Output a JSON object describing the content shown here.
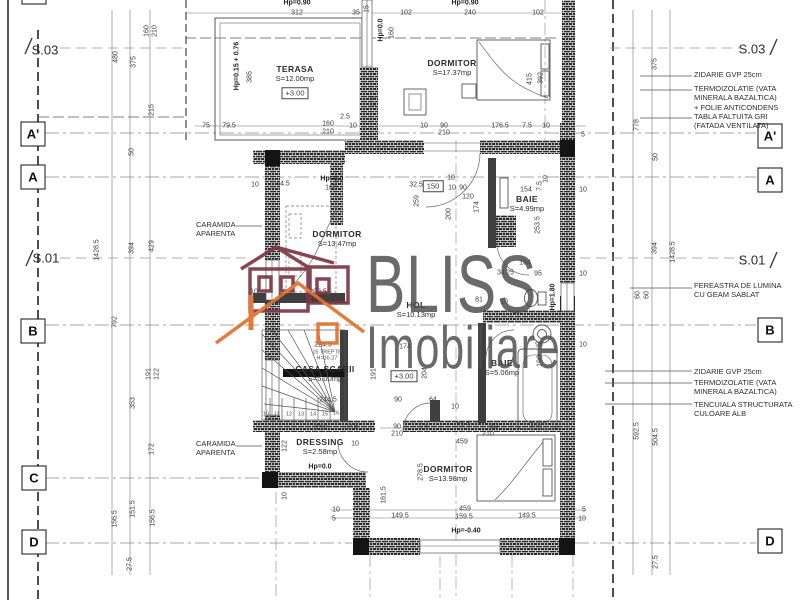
{
  "watermark": {
    "line1": "BLISS",
    "line2": "Imobiliare"
  },
  "grid_bubbles": [
    {
      "label": "",
      "x": 34,
      "y": -8
    },
    {
      "label": "A'",
      "x": 33,
      "y": 134
    },
    {
      "label": "A",
      "x": 33,
      "y": 177
    },
    {
      "label": "B",
      "x": 33,
      "y": 331
    },
    {
      "label": "C",
      "x": 34,
      "y": 478
    },
    {
      "label": "D",
      "x": 34,
      "y": 542
    },
    {
      "label": "A'",
      "x": 770,
      "y": 136
    },
    {
      "label": "A",
      "x": 770,
      "y": 180
    },
    {
      "label": "B",
      "x": 770,
      "y": 330
    },
    {
      "label": "D",
      "x": 770,
      "y": 541
    }
  ],
  "sections": [
    {
      "label": "S.03",
      "x": 45,
      "y": 50
    },
    {
      "label": "S.03",
      "x": 752,
      "y": 49
    },
    {
      "label": "S.01",
      "x": 46,
      "y": 258
    },
    {
      "label": "S.01",
      "x": 752,
      "y": 260
    }
  ],
  "rooms": [
    {
      "name": "TERASA",
      "area": "S=12.00mp",
      "x": 295,
      "y": 74
    },
    {
      "name": "DORMITOR",
      "area": "S=17.37mp",
      "x": 452,
      "y": 68
    },
    {
      "name": "DORMITOR",
      "area": "S=13.47mp",
      "x": 337,
      "y": 239
    },
    {
      "name": "BAIE",
      "area": "S=4.99mp",
      "x": 527,
      "y": 204
    },
    {
      "name": "HOL",
      "area": "S=10.13mp",
      "x": 416,
      "y": 310
    },
    {
      "name": "CASA SCARII",
      "area": "S=5.00mp",
      "x": 325,
      "y": 374
    },
    {
      "name": "BAIE",
      "area": "S=5.06mp",
      "x": 502,
      "y": 368
    },
    {
      "name": "DRESSING",
      "area": "S=2.58mp",
      "x": 320,
      "y": 447
    },
    {
      "name": "DORMITOR",
      "area": "S=13.98mp",
      "x": 448,
      "y": 474
    }
  ],
  "annotations": {
    "left": [
      {
        "lines": [
          "CARAMIDA",
          "APARENTA"
        ],
        "x": 196,
        "y": 220
      },
      {
        "lines": [
          "CARAMIDA",
          "APARENTA"
        ],
        "x": 196,
        "y": 439
      }
    ],
    "right": [
      {
        "lines": [
          "ZIDARIE GVP 25cm"
        ],
        "x": 694,
        "y": 70
      },
      {
        "lines": [
          "TERMOIZOLATIE (VATA",
          "MINERALA BAZALTICA)",
          "+ FOLIE ANTICONDENS"
        ],
        "x": 694,
        "y": 84
      },
      {
        "lines": [
          "TABLA FALTUITA GRI",
          "(FATADA VENTILATA)"
        ],
        "x": 694,
        "y": 112
      },
      {
        "lines": [
          "FEREASTRA DE LUMINA",
          "CU GEAM SABLAT"
        ],
        "x": 694,
        "y": 281
      },
      {
        "lines": [
          "ZIDARIE GVP 25cm"
        ],
        "x": 694,
        "y": 367
      },
      {
        "lines": [
          "TERMOIZOLATIE (VATA",
          "MINERALA BAZALTICA)"
        ],
        "x": 694,
        "y": 378
      },
      {
        "lines": [
          "TENCUIALA STRUCTURATA",
          "CULOARE ALB"
        ],
        "x": 694,
        "y": 400
      }
    ]
  },
  "labels": [
    {
      "t": "Hp=0.90",
      "x": 297,
      "y": 3,
      "b": 1
    },
    {
      "t": "312",
      "x": 297,
      "y": 13
    },
    {
      "t": "35",
      "x": 356,
      "y": 13
    },
    {
      "t": "15",
      "x": 367,
      "y": 9,
      "r": 1
    },
    {
      "t": "102",
      "x": 406,
      "y": 13
    },
    {
      "t": "Hp=0.90",
      "x": 465,
      "y": 3,
      "b": 1
    },
    {
      "t": "240",
      "x": 470,
      "y": 13
    },
    {
      "t": "102",
      "x": 538,
      "y": 13
    },
    {
      "t": "Hp=0.0",
      "x": 381,
      "y": 30,
      "r": 1,
      "b": 1
    },
    {
      "t": "160",
      "x": 392,
      "y": 33,
      "r": 1
    },
    {
      "t": "Hp=0.15 + 0.76",
      "x": 237,
      "y": 66,
      "r": 1,
      "b": 1
    },
    {
      "t": "385",
      "x": 250,
      "y": 77,
      "r": 1
    },
    {
      "t": "175",
      "x": 374,
      "y": 102,
      "r": 1
    },
    {
      "t": "75",
      "x": 206,
      "y": 126
    },
    {
      "t": "79.5",
      "x": 229,
      "y": 126
    },
    {
      "t": "160",
      "x": 328,
      "y": 124
    },
    {
      "t": "210",
      "x": 328,
      "y": 132
    },
    {
      "t": "2.5",
      "x": 345,
      "y": 117
    },
    {
      "t": "10",
      "x": 353,
      "y": 126
    },
    {
      "t": "10",
      "x": 424,
      "y": 126
    },
    {
      "t": "90",
      "x": 444,
      "y": 126
    },
    {
      "t": "210",
      "x": 444,
      "y": 133
    },
    {
      "t": "176.5",
      "x": 500,
      "y": 126
    },
    {
      "t": "7.5",
      "x": 527,
      "y": 126
    },
    {
      "t": "10",
      "x": 546,
      "y": 126
    },
    {
      "t": "5",
      "x": 583,
      "y": 135
    },
    {
      "t": "415",
      "x": 530,
      "y": 79,
      "r": 1
    },
    {
      "t": "392",
      "x": 541,
      "y": 78,
      "r": 1
    },
    {
      "t": "480",
      "x": 116,
      "y": 57,
      "r": 1
    },
    {
      "t": "375",
      "x": 134,
      "y": 62,
      "r": 1
    },
    {
      "t": "160",
      "x": 147,
      "y": 31,
      "r": 1
    },
    {
      "t": "210",
      "x": 155,
      "y": 31,
      "r": 1
    },
    {
      "t": "215",
      "x": 152,
      "y": 110,
      "r": 1
    },
    {
      "t": "50",
      "x": 132,
      "y": 152,
      "r": 1
    },
    {
      "t": "1428.5",
      "x": 97,
      "y": 250,
      "r": 1
    },
    {
      "t": "394",
      "x": 132,
      "y": 248,
      "r": 1
    },
    {
      "t": "429",
      "x": 152,
      "y": 246,
      "r": 1
    },
    {
      "t": "792",
      "x": 115,
      "y": 322,
      "r": 1
    },
    {
      "t": "191",
      "x": 149,
      "y": 374,
      "r": 1
    },
    {
      "t": "122",
      "x": 157,
      "y": 374,
      "r": 1
    },
    {
      "t": "353",
      "x": 133,
      "y": 403,
      "r": 1
    },
    {
      "t": "172",
      "x": 152,
      "y": 449,
      "r": 1
    },
    {
      "t": "156.5",
      "x": 115,
      "y": 519,
      "r": 1
    },
    {
      "t": "151.5",
      "x": 133,
      "y": 509,
      "r": 1
    },
    {
      "t": "156.5",
      "x": 153,
      "y": 518,
      "r": 1
    },
    {
      "t": "27.5",
      "x": 130,
      "y": 564,
      "r": 1
    },
    {
      "t": "375",
      "x": 655,
      "y": 64,
      "r": 1
    },
    {
      "t": "778",
      "x": 637,
      "y": 125,
      "r": 1
    },
    {
      "t": "50",
      "x": 656,
      "y": 157,
      "r": 1
    },
    {
      "t": "394",
      "x": 655,
      "y": 248,
      "r": 1
    },
    {
      "t": "1428.5",
      "x": 673,
      "y": 252,
      "r": 1
    },
    {
      "t": "60",
      "x": 638,
      "y": 295,
      "r": 1
    },
    {
      "t": "60",
      "x": 647,
      "y": 295,
      "r": 1
    },
    {
      "t": "592.5",
      "x": 637,
      "y": 431,
      "r": 1
    },
    {
      "t": "504.5",
      "x": 656,
      "y": 437,
      "r": 1
    },
    {
      "t": "27.5",
      "x": 656,
      "y": 562,
      "r": 1
    },
    {
      "t": "10",
      "x": 255,
      "y": 185
    },
    {
      "t": "44.5",
      "x": 283,
      "y": 184
    },
    {
      "t": "Hp=0.0",
      "x": 332,
      "y": 179,
      "b": 1
    },
    {
      "t": "160",
      "x": 331,
      "y": 188
    },
    {
      "t": "32.5",
      "x": 416,
      "y": 185
    },
    {
      "t": "150",
      "x": 433,
      "y": 186,
      "box": 1
    },
    {
      "t": "10",
      "x": 451,
      "y": 178
    },
    {
      "t": "10",
      "x": 452,
      "y": 188
    },
    {
      "t": "90",
      "x": 463,
      "y": 188
    },
    {
      "t": "120",
      "x": 468,
      "y": 197
    },
    {
      "t": "174",
      "x": 477,
      "y": 207,
      "r": 1
    },
    {
      "t": "259",
      "x": 417,
      "y": 201,
      "r": 1
    },
    {
      "t": "200",
      "x": 449,
      "y": 214,
      "r": 1
    },
    {
      "t": "154",
      "x": 526,
      "y": 190
    },
    {
      "t": "7.5",
      "x": 540,
      "y": 186,
      "r": 1
    },
    {
      "t": "10",
      "x": 546,
      "y": 179,
      "r": 1
    },
    {
      "t": "10",
      "x": 583,
      "y": 190
    },
    {
      "t": "253.5",
      "x": 538,
      "y": 225,
      "r": 1
    },
    {
      "t": "209.5",
      "x": 318,
      "y": 292
    },
    {
      "t": "10",
      "x": 254,
      "y": 292
    },
    {
      "t": "154",
      "x": 525,
      "y": 263
    },
    {
      "t": "34",
      "x": 501,
      "y": 273
    },
    {
      "t": "25",
      "x": 510,
      "y": 273
    },
    {
      "t": "95",
      "x": 538,
      "y": 274
    },
    {
      "t": "10",
      "x": 583,
      "y": 274
    },
    {
      "t": "81",
      "x": 479,
      "y": 300
    },
    {
      "t": "10",
      "x": 504,
      "y": 302
    },
    {
      "t": "Hp=1.80",
      "x": 553,
      "y": 297,
      "r": 1,
      "b": 1
    },
    {
      "t": "95",
      "x": 539,
      "y": 345
    },
    {
      "t": "10",
      "x": 583,
      "y": 345
    },
    {
      "t": "190",
      "x": 540,
      "y": 361,
      "r": 1
    },
    {
      "t": "174",
      "x": 405,
      "y": 347
    },
    {
      "t": "204",
      "x": 425,
      "y": 373,
      "r": 1
    },
    {
      "t": "191",
      "x": 374,
      "y": 374,
      "r": 1
    },
    {
      "t": "90",
      "x": 398,
      "y": 400
    },
    {
      "t": "64",
      "x": 433,
      "y": 400
    },
    {
      "t": "10",
      "x": 455,
      "y": 407
    },
    {
      "t": "90",
      "x": 397,
      "y": 427
    },
    {
      "t": "210",
      "x": 397,
      "y": 434
    },
    {
      "t": "74",
      "x": 424,
      "y": 427
    },
    {
      "t": "73.5",
      "x": 463,
      "y": 426
    },
    {
      "t": "459",
      "x": 462,
      "y": 442
    },
    {
      "t": "224.5",
      "x": 323,
      "y": 345
    },
    {
      "t": "16 TREPTE",
      "x": 327,
      "y": 353,
      "s": 1
    },
    {
      "t": "H=16.27",
      "x": 327,
      "y": 359,
      "s": 1
    },
    {
      "t": "244.5",
      "x": 328,
      "y": 400
    },
    {
      "t": "212",
      "x": 321,
      "y": 428
    },
    {
      "t": "22.5",
      "x": 351,
      "y": 427
    },
    {
      "t": "122",
      "x": 285,
      "y": 446,
      "r": 1
    },
    {
      "t": "10",
      "x": 285,
      "y": 496,
      "r": 1
    },
    {
      "t": "10",
      "x": 355,
      "y": 444
    },
    {
      "t": "10",
      "x": 266,
      "y": 415,
      "s": 1
    },
    {
      "t": "11",
      "x": 277,
      "y": 415,
      "s": 1
    },
    {
      "t": "12",
      "x": 289,
      "y": 415,
      "s": 1
    },
    {
      "t": "13",
      "x": 301,
      "y": 415,
      "s": 1
    },
    {
      "t": "14",
      "x": 313,
      "y": 415,
      "s": 1
    },
    {
      "t": "15",
      "x": 325,
      "y": 415,
      "s": 1
    },
    {
      "t": "16",
      "x": 336,
      "y": 414,
      "s": 1
    },
    {
      "t": "Hp=0.0",
      "x": 320,
      "y": 467,
      "b": 1
    },
    {
      "t": "161.5",
      "x": 384,
      "y": 495,
      "r": 1
    },
    {
      "t": "80",
      "x": 494,
      "y": 427
    },
    {
      "t": "120",
      "x": 536,
      "y": 428
    },
    {
      "t": "210",
      "x": 488,
      "y": 434
    },
    {
      "t": "278.5",
      "x": 421,
      "y": 472,
      "r": 1
    },
    {
      "t": "459",
      "x": 465,
      "y": 509
    },
    {
      "t": "159.5",
      "x": 464,
      "y": 517
    },
    {
      "t": "149.5",
      "x": 400,
      "y": 516
    },
    {
      "t": "149.5",
      "x": 527,
      "y": 516
    },
    {
      "t": "10",
      "x": 336,
      "y": 510
    },
    {
      "t": "5",
      "x": 334,
      "y": 519
    },
    {
      "t": "5",
      "x": 584,
      "y": 510
    },
    {
      "t": "10",
      "x": 582,
      "y": 519
    },
    {
      "t": "Hp=-0.40",
      "x": 466,
      "y": 531,
      "b": 1
    },
    {
      "t": "+3.00",
      "x": 295,
      "y": 93,
      "box": 1
    },
    {
      "t": "+3.00",
      "x": 404,
      "y": 376,
      "box": 1
    }
  ]
}
